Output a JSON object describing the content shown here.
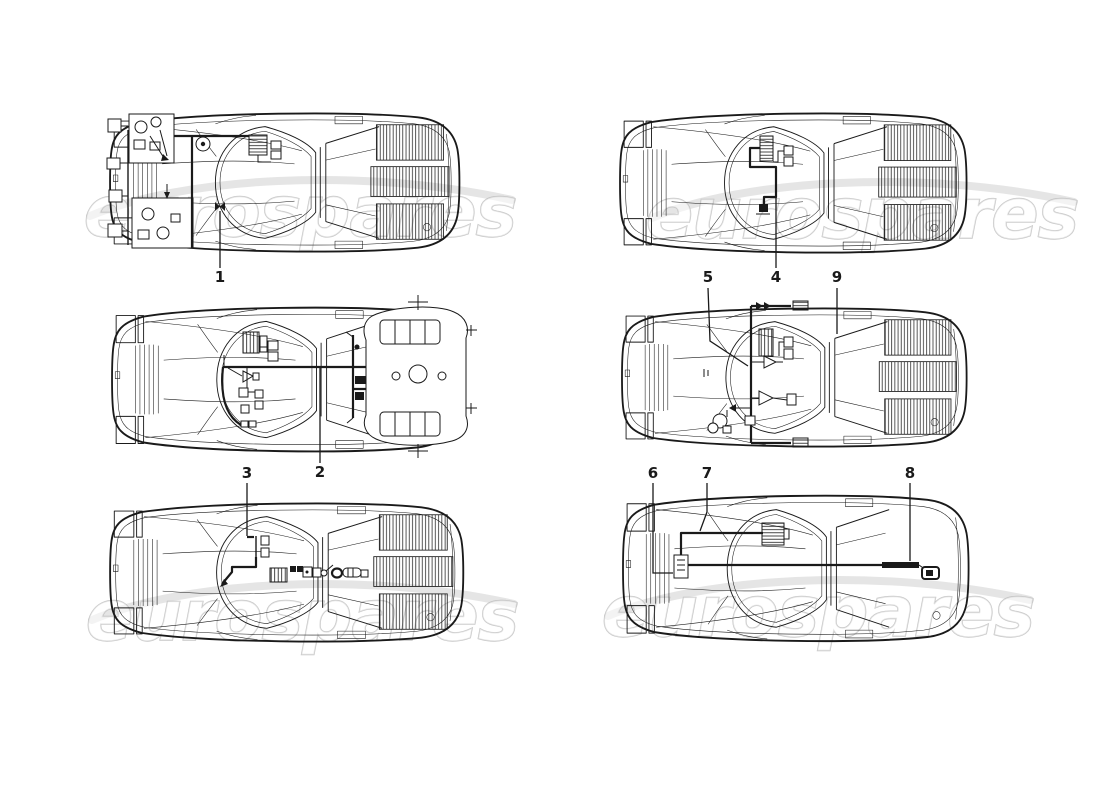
{
  "watermark": {
    "text": "eurospares"
  },
  "colors": {
    "ink": "#1a1a1a",
    "background": "#ffffff",
    "watermark_stroke": "#b5b5b5"
  },
  "callouts": [
    {
      "number": "1"
    },
    {
      "number": "2"
    },
    {
      "number": "3"
    },
    {
      "number": "4"
    },
    {
      "number": "5"
    },
    {
      "number": "6"
    },
    {
      "number": "7"
    },
    {
      "number": "8"
    },
    {
      "number": "9"
    }
  ]
}
